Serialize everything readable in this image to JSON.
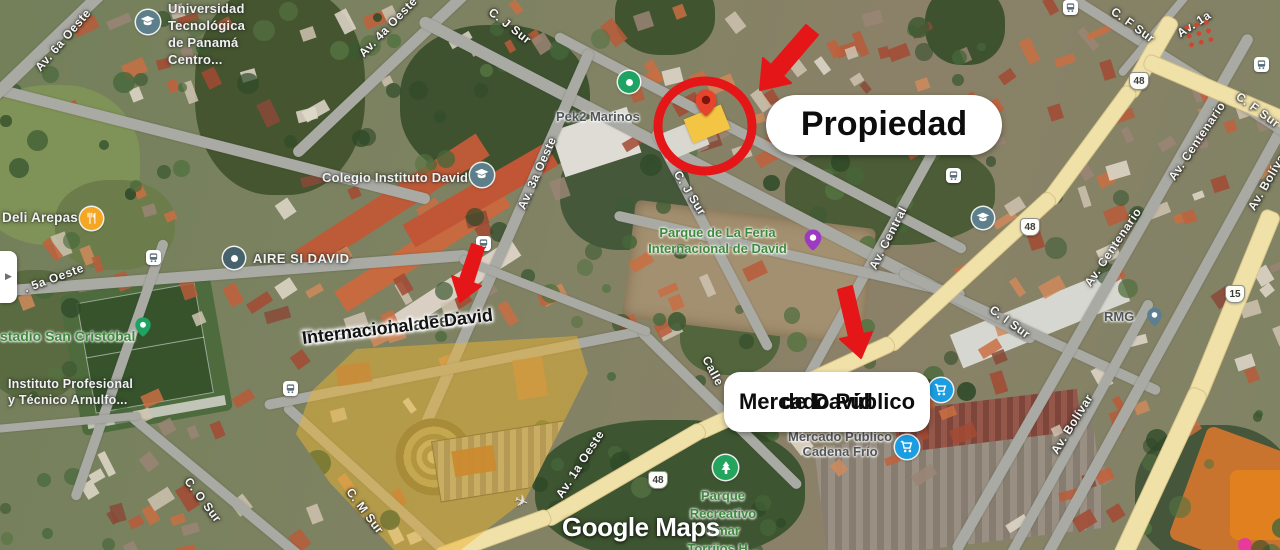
{
  "colors": {
    "annotation-red": "#e41618",
    "highlight-yellow": "#f4c542",
    "park-green": "#3f8a3f",
    "cart-blue": "#1b9de2",
    "school-slate": "#5d7f8c",
    "pin-green": "#1ea362",
    "pin-purple": "#9d3ac2",
    "restaurant-orange": "#f5a623"
  },
  "annotations": {
    "propiedad": "Propiedad",
    "terrenos": [
      "Terrenos de la Feria",
      "Internacional de David"
    ],
    "mercado": [
      "Mercado Público",
      "de David"
    ]
  },
  "watermark": "Google Maps",
  "panel_toggle": "▶",
  "shields": {
    "r48": "48",
    "r15": "15"
  },
  "streets": [
    {
      "label": "Av. 6a Oeste"
    },
    {
      "label": "Av. 4a Oeste"
    },
    {
      "label": "C. J Sur"
    },
    {
      "label": "C. J Sur"
    },
    {
      "label": "Av. 3a Oeste"
    },
    {
      "label": ". 5a Oeste"
    },
    {
      "label": "C. O Sur"
    },
    {
      "label": "C. M Sur"
    },
    {
      "label": "Av. 1a Oeste"
    },
    {
      "label": "Calle"
    },
    {
      "label": "Av. Central"
    },
    {
      "label": "C. I Sur"
    },
    {
      "label": "Av. Centenario"
    },
    {
      "label": "Av. Centenario"
    },
    {
      "label": "Av. Bolívar"
    },
    {
      "label": "Av. Bolívar"
    },
    {
      "label": "C. F Sur"
    },
    {
      "label": "C. F Sur"
    },
    {
      "label": "Av. 1a"
    }
  ],
  "pois": [
    {
      "name": "universidad-tecnologica",
      "lines": [
        "Universidad",
        "Tecnológica",
        "de Panamá",
        "Centro..."
      ]
    },
    {
      "name": "pek2-marinos",
      "label": "Pek2 Marinos"
    },
    {
      "name": "deli-arepas",
      "label": "Deli Arepas"
    },
    {
      "name": "aire-si-david",
      "label": "AIRE SI DAVID"
    },
    {
      "name": "colegio-instituto-david",
      "label": "Colegio Instituto David"
    },
    {
      "name": "estadio-san-cristobal",
      "label": "stadio San Cristóbal"
    },
    {
      "name": "instituto-profesional",
      "lines": [
        "Instituto Profesional",
        "y Técnico Arnulfo..."
      ]
    },
    {
      "name": "parque-de-la-feria",
      "lines": [
        "Parque de La Feria",
        "Internacional de David"
      ]
    },
    {
      "name": "mercado-cadena-frio",
      "lines": [
        "Mercado Público",
        "Cadena Frío"
      ]
    },
    {
      "name": "rmg",
      "label": "RMG"
    },
    {
      "name": "parque-recreativo",
      "lines": [
        "Parque",
        "Recreativo",
        "Omar",
        "Torrijos H..."
      ]
    }
  ]
}
